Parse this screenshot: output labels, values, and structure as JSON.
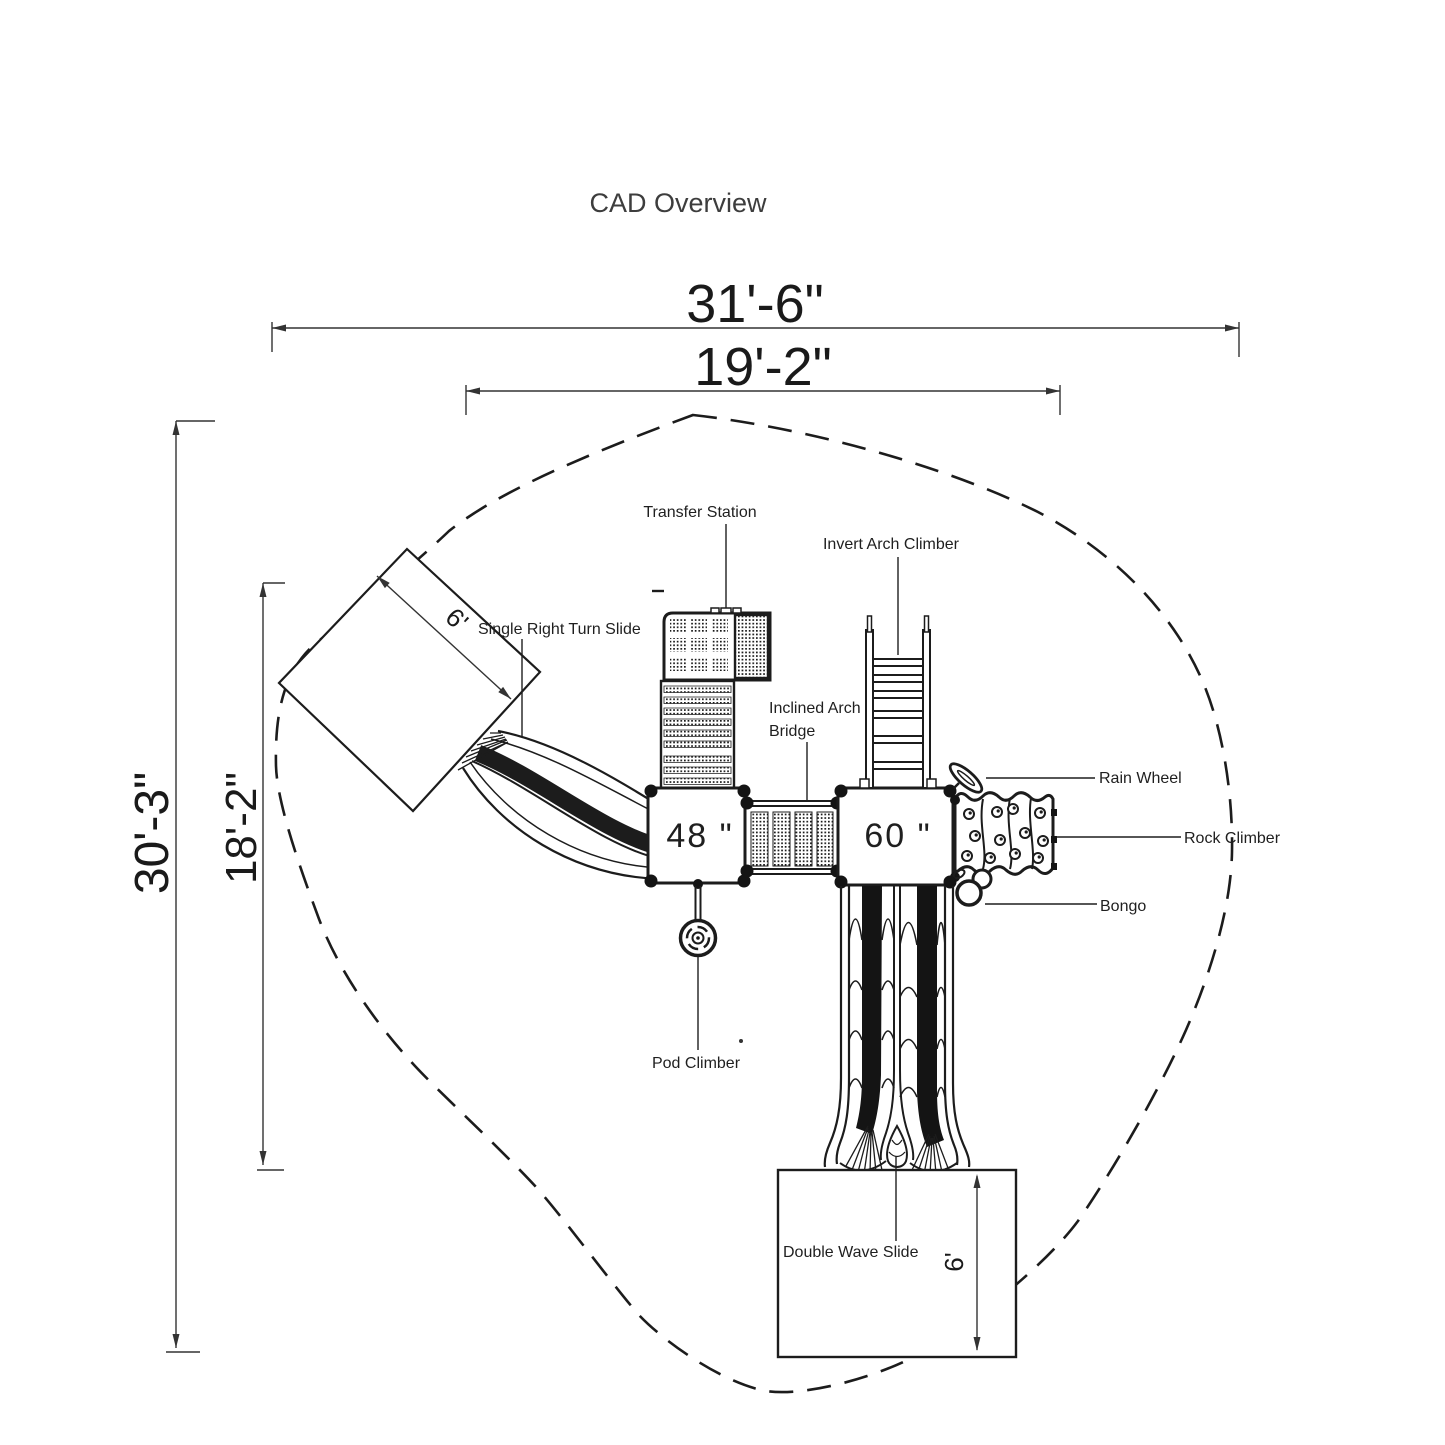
{
  "title": "CAD Overview",
  "colors": {
    "accent_green": "#6abf47",
    "line": "#1c1c1c"
  },
  "dimensions": {
    "overall_width": "31'-6\"",
    "deck_span_width": "19'-2\"",
    "overall_depth": "30'-3\"",
    "deck_span_depth": "18'-2\"",
    "slide_exit_zone_left": "6'",
    "slide_exit_zone_bottom": "6'"
  },
  "deck_heights": {
    "deck_48": "48 \"",
    "deck_60": "60 \""
  },
  "components": {
    "transfer_station": "Transfer Station",
    "invert_arch_climber": "Invert Arch Climber",
    "single_right_turn_slide": "Single Right Turn Slide",
    "inclined_arch_bridge": [
      "Inclined Arch",
      "Bridge"
    ],
    "rain_wheel": "Rain Wheel",
    "rock_climber": "Rock Climber",
    "bongo": "Bongo",
    "pod_climber": "Pod Climber",
    "double_wave_slide": "Double Wave Slide"
  }
}
